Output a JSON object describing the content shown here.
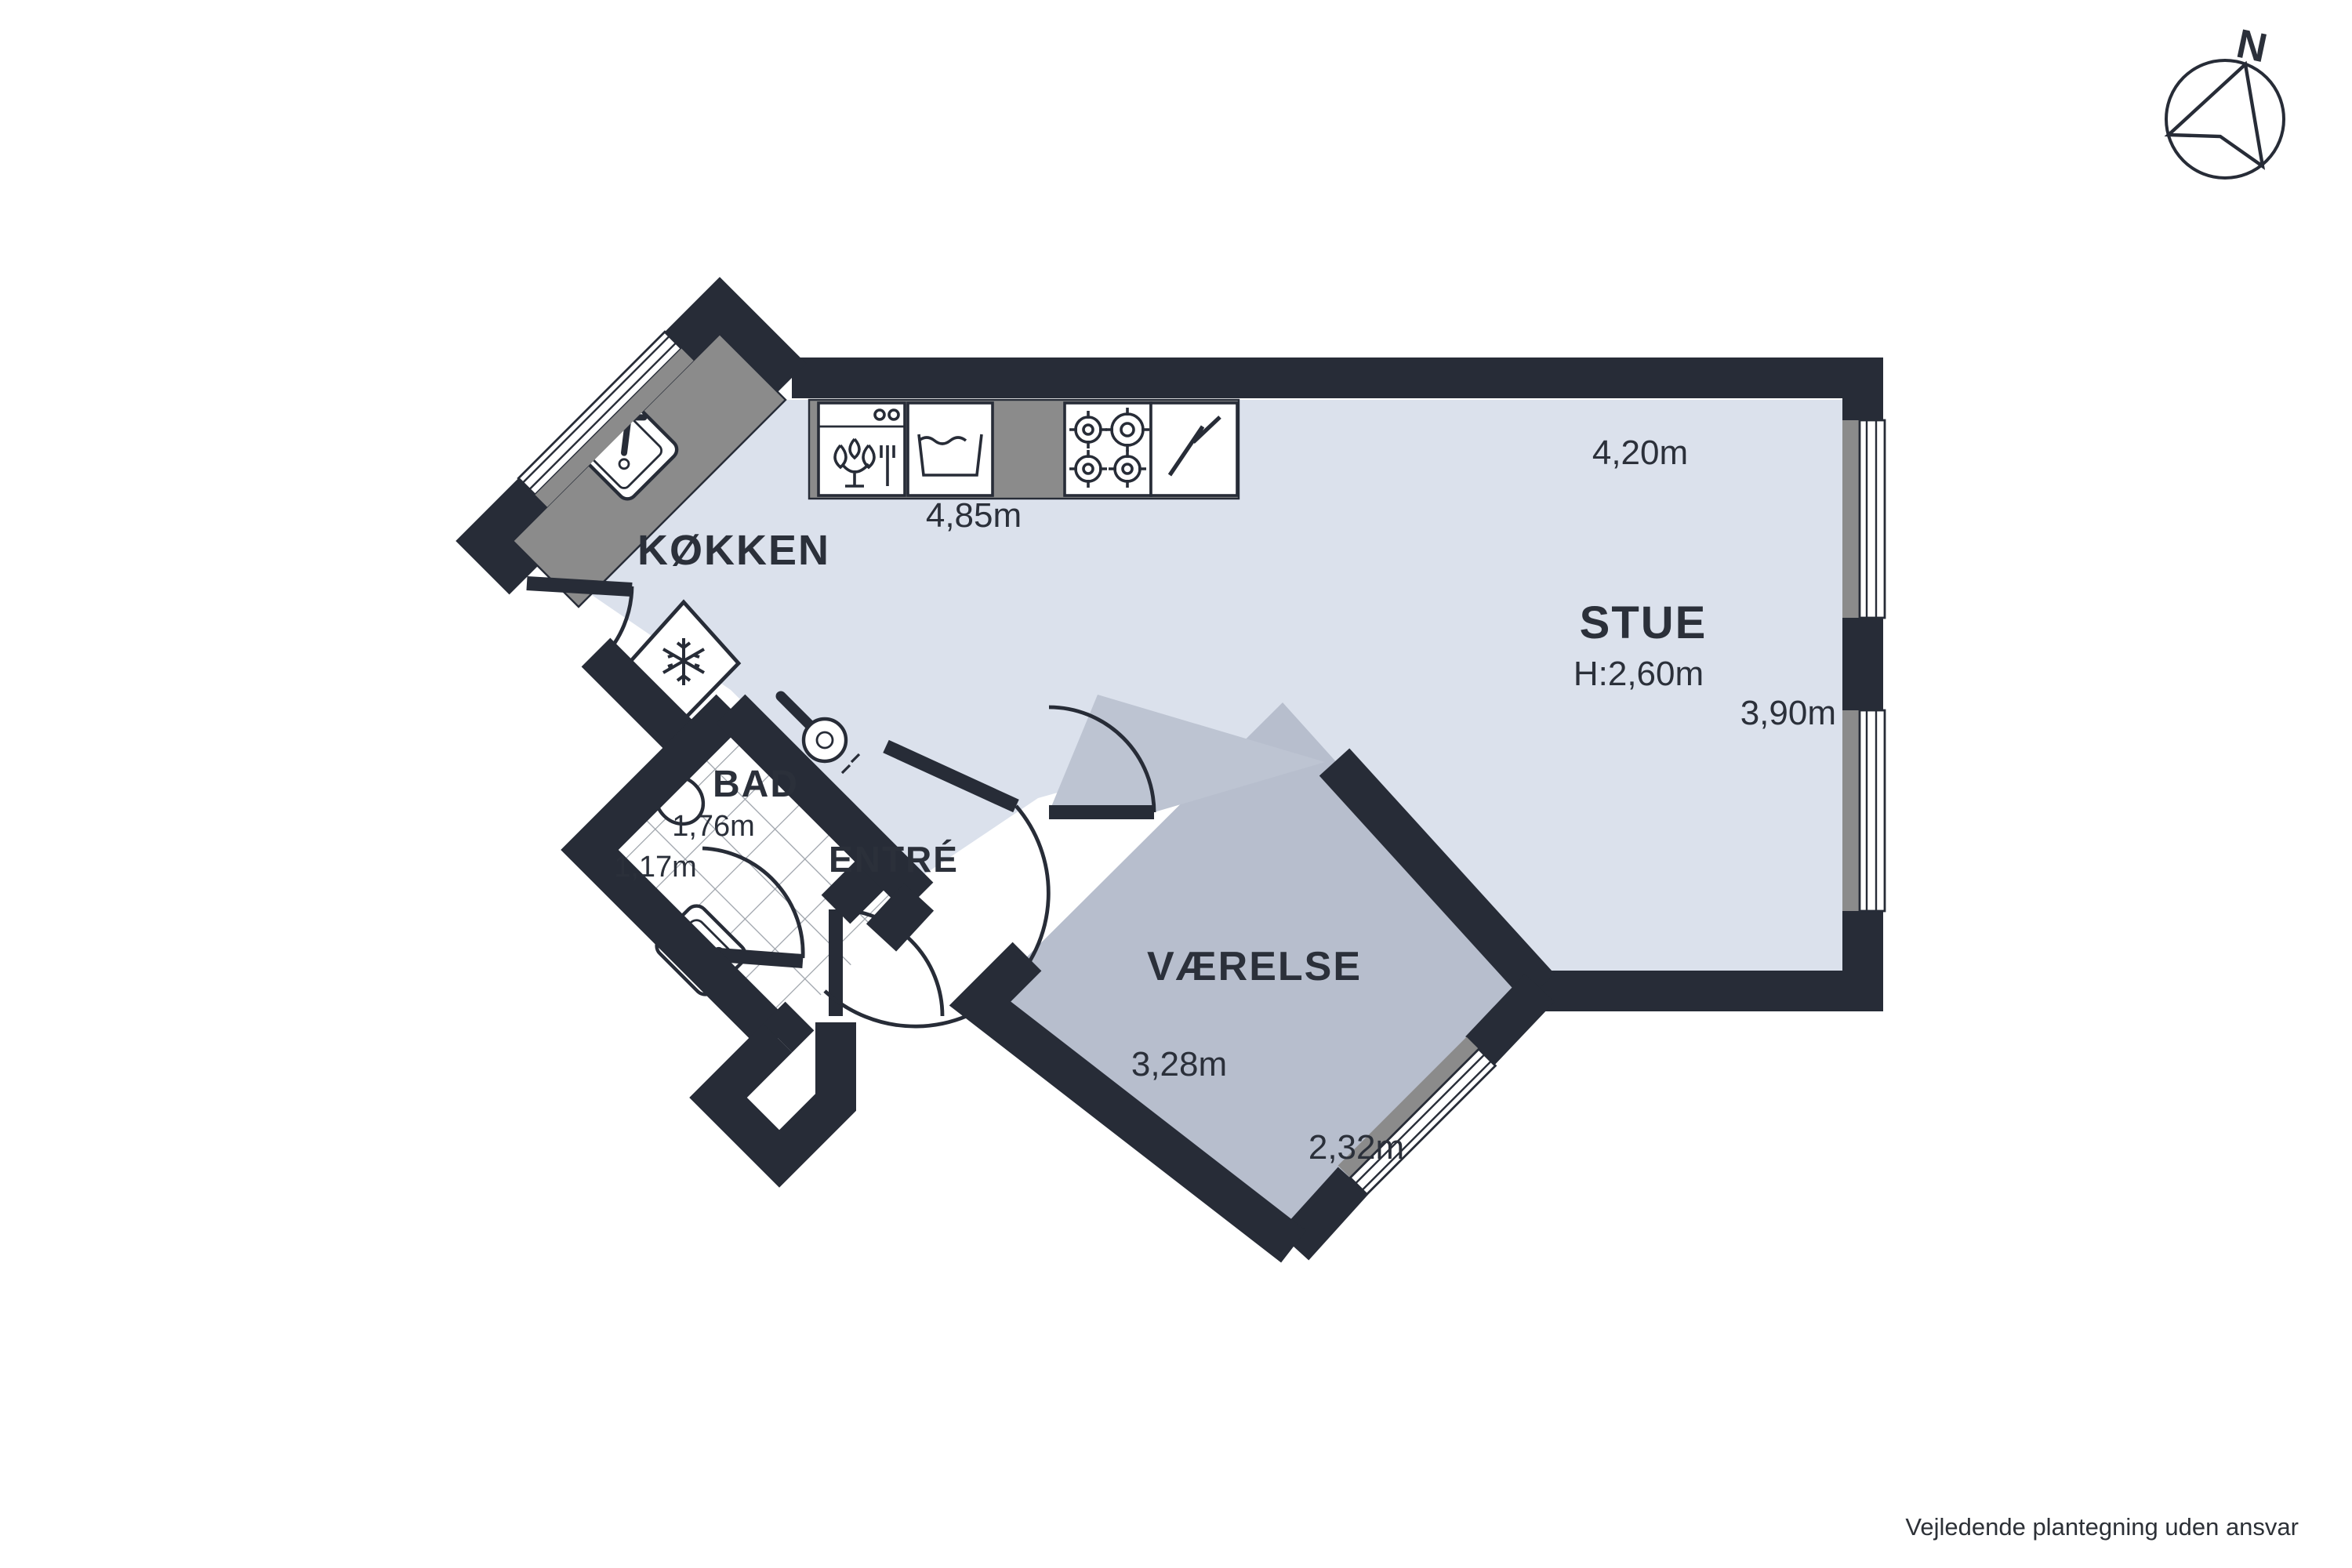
{
  "disclaimer": "Vejledende plantegning uden ansvar",
  "compass": {
    "north_label": "N"
  },
  "rooms": {
    "koekken": {
      "name": "KØKKEN",
      "counter_length": "4,85m"
    },
    "stue": {
      "name": "STUE",
      "ceiling_height": "H:2,60m",
      "width_top": "4,20m",
      "depth_right": "3,90m"
    },
    "bad": {
      "name": "BAD",
      "width": "1,76m",
      "depth": "1,17m"
    },
    "entre": {
      "name": "ENTRÉ"
    },
    "vaerelse": {
      "name": "VÆRELSE",
      "width": "3,28m",
      "depth": "2,32m"
    }
  },
  "colors": {
    "wall": "#272c37",
    "floor_main": "#dbe1ec",
    "floor_room": "#b7becd",
    "floor_swing": "#bdc4d2",
    "counter": "#8b8b8b",
    "tile_line": "#9aa0a8",
    "text": "#2b303a"
  }
}
